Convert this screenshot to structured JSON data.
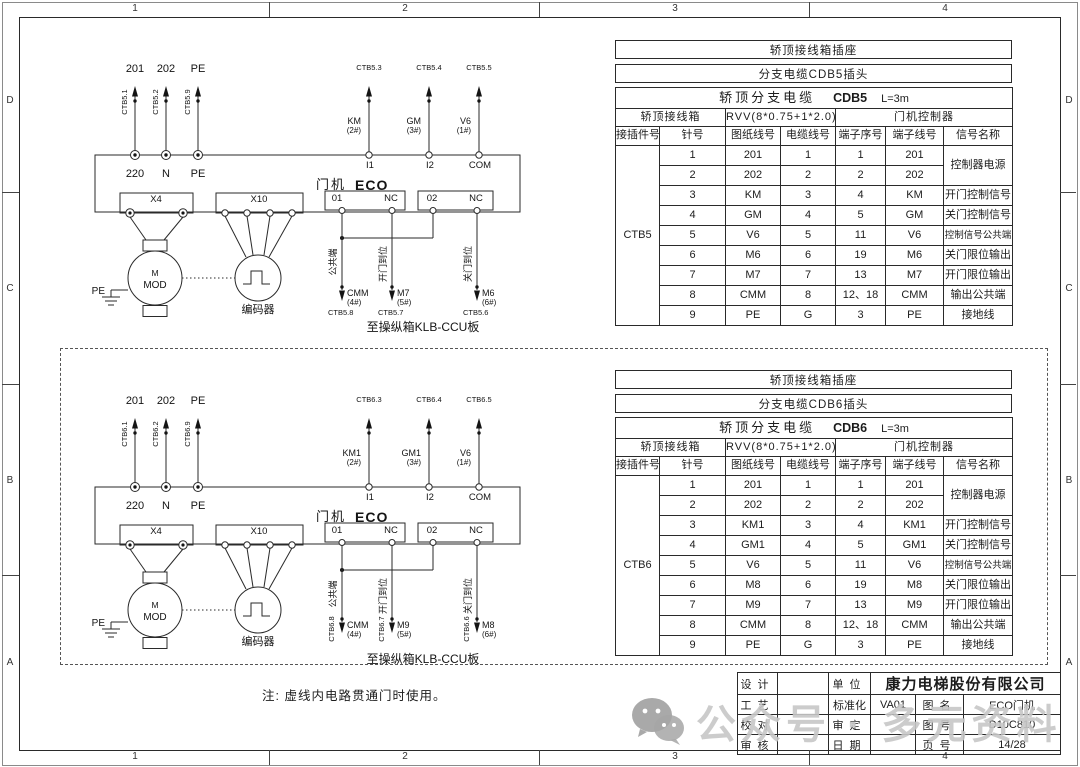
{
  "frame": {
    "cols": [
      "1",
      "2",
      "3",
      "4"
    ],
    "rows": [
      "D",
      "C",
      "B",
      "A"
    ]
  },
  "note": "注: 虚线内电路贯通门时使用。",
  "watermark": {
    "icon": "wechat-icon",
    "text": "公众号 · 多元资料"
  },
  "diagrams": [
    {
      "power_top_labels": [
        "201",
        "202",
        "PE"
      ],
      "power_wire_ids": [
        "CTB5.1",
        "CTB5.2",
        "CTB5.9"
      ],
      "power_terms": [
        "220",
        "N",
        "PE"
      ],
      "machine_label": "门机",
      "machine_model": "ECO",
      "connector_x4": "X4",
      "connector_x10": "X10",
      "relay1_a": "01",
      "relay1_b": "NC",
      "relay2_a": "02",
      "relay2_b": "NC",
      "signal_wire_ids": [
        "CTB5.3",
        "CTB5.4",
        "CTB5.5"
      ],
      "signal_labels": [
        "KM",
        "GM",
        "V6"
      ],
      "signal_pins": [
        "(2#)",
        "(3#)",
        "(1#)"
      ],
      "input_terms": [
        "I1",
        "I2",
        "COM"
      ],
      "motor_label": "M",
      "motor_model": "MOD",
      "pe_label": "PE",
      "encoder_label": "编码器",
      "out_functions": [
        "公共端",
        "开门到位",
        "关门到位"
      ],
      "out_labels": [
        "CMM",
        "M7",
        "M6"
      ],
      "out_pins": [
        "(4#)",
        "(5#)",
        "(6#)"
      ],
      "out_wire_ids": [
        "CTB5.8",
        "CTB5.7",
        "CTB5.6"
      ],
      "caption": "至操纵箱KLB-CCU板"
    },
    {
      "power_top_labels": [
        "201",
        "202",
        "PE"
      ],
      "power_wire_ids": [
        "CTB6.1",
        "CTB6.2",
        "CTB6.9"
      ],
      "power_terms": [
        "220",
        "N",
        "PE"
      ],
      "machine_label": "门机",
      "machine_model": "ECO",
      "connector_x4": "X4",
      "connector_x10": "X10",
      "relay1_a": "01",
      "relay1_b": "NC",
      "relay2_a": "02",
      "relay2_b": "NC",
      "signal_wire_ids": [
        "CTB6.3",
        "CTB6.4",
        "CTB6.5"
      ],
      "signal_labels": [
        "KM1",
        "GM1",
        "V6"
      ],
      "signal_pins": [
        "(2#)",
        "(3#)",
        "(1#)"
      ],
      "input_terms": [
        "I1",
        "I2",
        "COM"
      ],
      "motor_label": "M",
      "motor_model": "MOD",
      "pe_label": "PE",
      "encoder_label": "编码器",
      "out_functions": [
        "公共端",
        "开门到位",
        "关门到位"
      ],
      "out_labels": [
        "CMM",
        "M9",
        "M8"
      ],
      "out_pins": [
        "(4#)",
        "(5#)",
        "(6#)"
      ],
      "out_wire_ids": [
        "CTB6.8",
        "CTB6.7",
        "CTB6.6"
      ],
      "caption": "至操纵箱KLB-CCU板"
    }
  ],
  "tables": [
    {
      "banner1": "轿顶接线箱插座",
      "banner2": "分支电缆CDB5插头",
      "title": "轿顶分支电缆",
      "cable_code": "CDB5",
      "cable_length": "L=3m",
      "group_headers": [
        "轿顶接线箱",
        "RVV(8*0.75+1*2.0)",
        "门机控制器"
      ],
      "col_headers": [
        "接插件号",
        "针号",
        "图纸线号",
        "电缆线号",
        "端子序号",
        "端子线号",
        "信号名称"
      ],
      "connector_id": "CTB5",
      "merged_signal": "控制器电源",
      "rows": [
        {
          "pin": "1",
          "paper": "201",
          "cable": "1",
          "seq": "1",
          "term": "201"
        },
        {
          "pin": "2",
          "paper": "202",
          "cable": "2",
          "seq": "2",
          "term": "202"
        },
        {
          "pin": "3",
          "paper": "KM",
          "cable": "3",
          "seq": "4",
          "term": "KM",
          "signal": "开门控制信号"
        },
        {
          "pin": "4",
          "paper": "GM",
          "cable": "4",
          "seq": "5",
          "term": "GM",
          "signal": "关门控制信号"
        },
        {
          "pin": "5",
          "paper": "V6",
          "cable": "5",
          "seq": "11",
          "term": "V6",
          "signal": "控制信号公共端"
        },
        {
          "pin": "6",
          "paper": "M6",
          "cable": "6",
          "seq": "19",
          "term": "M6",
          "signal": "关门限位输出"
        },
        {
          "pin": "7",
          "paper": "M7",
          "cable": "7",
          "seq": "13",
          "term": "M7",
          "signal": "开门限位输出"
        },
        {
          "pin": "8",
          "paper": "CMM",
          "cable": "8",
          "seq": "12、18",
          "term": "CMM",
          "signal": "输出公共端"
        },
        {
          "pin": "9",
          "paper": "PE",
          "cable": "G",
          "seq": "3",
          "term": "PE",
          "signal": "接地线"
        }
      ]
    },
    {
      "banner1": "轿顶接线箱插座",
      "banner2": "分支电缆CDB6插头",
      "title": "轿顶分支电缆",
      "cable_code": "CDB6",
      "cable_length": "L=3m",
      "group_headers": [
        "轿顶接线箱",
        "RVV(8*0.75+1*2.0)",
        "门机控制器"
      ],
      "col_headers": [
        "接插件号",
        "针号",
        "图纸线号",
        "电缆线号",
        "端子序号",
        "端子线号",
        "信号名称"
      ],
      "connector_id": "CTB6",
      "merged_signal": "控制器电源",
      "rows": [
        {
          "pin": "1",
          "paper": "201",
          "cable": "1",
          "seq": "1",
          "term": "201"
        },
        {
          "pin": "2",
          "paper": "202",
          "cable": "2",
          "seq": "2",
          "term": "202"
        },
        {
          "pin": "3",
          "paper": "KM1",
          "cable": "3",
          "seq": "4",
          "term": "KM1",
          "signal": "开门控制信号"
        },
        {
          "pin": "4",
          "paper": "GM1",
          "cable": "4",
          "seq": "5",
          "term": "GM1",
          "signal": "关门控制信号"
        },
        {
          "pin": "5",
          "paper": "V6",
          "cable": "5",
          "seq": "11",
          "term": "V6",
          "signal": "控制信号公共端"
        },
        {
          "pin": "6",
          "paper": "M8",
          "cable": "6",
          "seq": "19",
          "term": "M8",
          "signal": "关门限位输出"
        },
        {
          "pin": "7",
          "paper": "M9",
          "cable": "7",
          "seq": "13",
          "term": "M9",
          "signal": "开门限位输出"
        },
        {
          "pin": "8",
          "paper": "CMM",
          "cable": "8",
          "seq": "12、18",
          "term": "CMM",
          "signal": "输出公共端"
        },
        {
          "pin": "9",
          "paper": "PE",
          "cable": "G",
          "seq": "3",
          "term": "PE",
          "signal": "接地线"
        }
      ]
    }
  ],
  "title_block": {
    "rows": [
      {
        "l": "设计",
        "m": "单位"
      },
      {
        "l": "工艺",
        "m": "标准化"
      },
      {
        "l": "校对",
        "m": "审定"
      },
      {
        "l": "审核",
        "m": "日期"
      }
    ],
    "company": "康力电梯股份有限公司",
    "std_value": "VA01",
    "name_label": "图名",
    "name_value": "ECO门机",
    "no_label": "图号",
    "no_value": "D10C810",
    "page_label": "页号",
    "page_value": "14/28"
  }
}
